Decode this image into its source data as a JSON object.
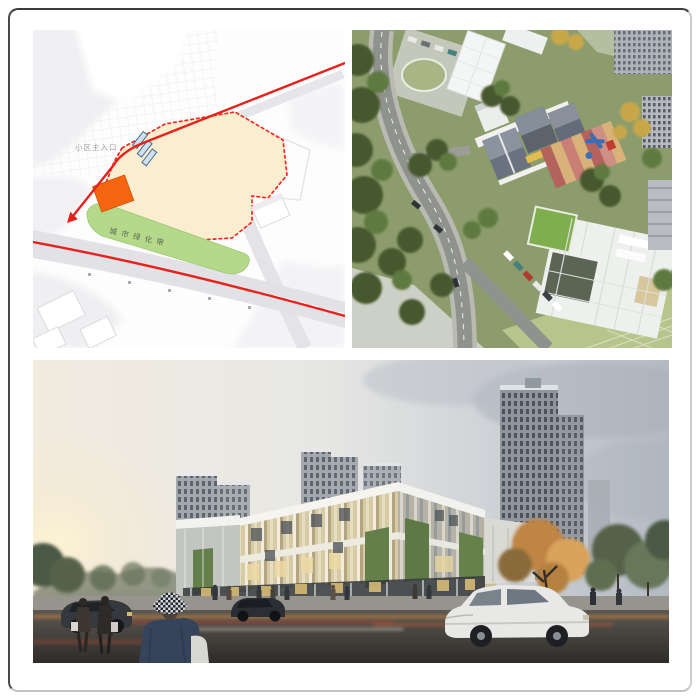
{
  "page": {
    "description": "Architectural design presentation collage: site plan diagram, aerial rendering, street-level rendering"
  },
  "site_plan": {
    "alt": "site analysis plan with circulation routes",
    "labels": {
      "main_entrance": "小区主入口",
      "green_belt": "城市绿化带"
    },
    "colors": {
      "plot_fill": "#fbeed0",
      "boundary_red": "#ee2b20",
      "building_orange": "#f3660f",
      "green_belt": "#b5d98a",
      "route_red": "#e8211d",
      "road_gray": "#e4e4e8",
      "entrance_arrow": "#cfe0ee"
    }
  },
  "aerial_view": {
    "alt": "aerial rendering of kindergarten campus with playground, roads and neighborhood buildings",
    "colors": {
      "tree_green": "#4c6137",
      "grass": "#8aa055",
      "road": "#90928d",
      "white_roof": "#f2f4f3",
      "slate_roof": "#5c636d",
      "playground_red": "#b4625c",
      "playground_tan": "#d9b27a",
      "green_roof": "#7fae4e"
    }
  },
  "street_view": {
    "alt": "street-level dusk rendering of a glass community center with residential towers behind",
    "colors": {
      "sky_top": "#b3bac3",
      "sun_glow": "#f9efd5",
      "tower_gray": "#9aa0a6",
      "facade_warm": "#d2c49e",
      "green_wall": "#657f4b",
      "road_dark": "#3a3733",
      "car_white": "#e8e8e6"
    }
  }
}
